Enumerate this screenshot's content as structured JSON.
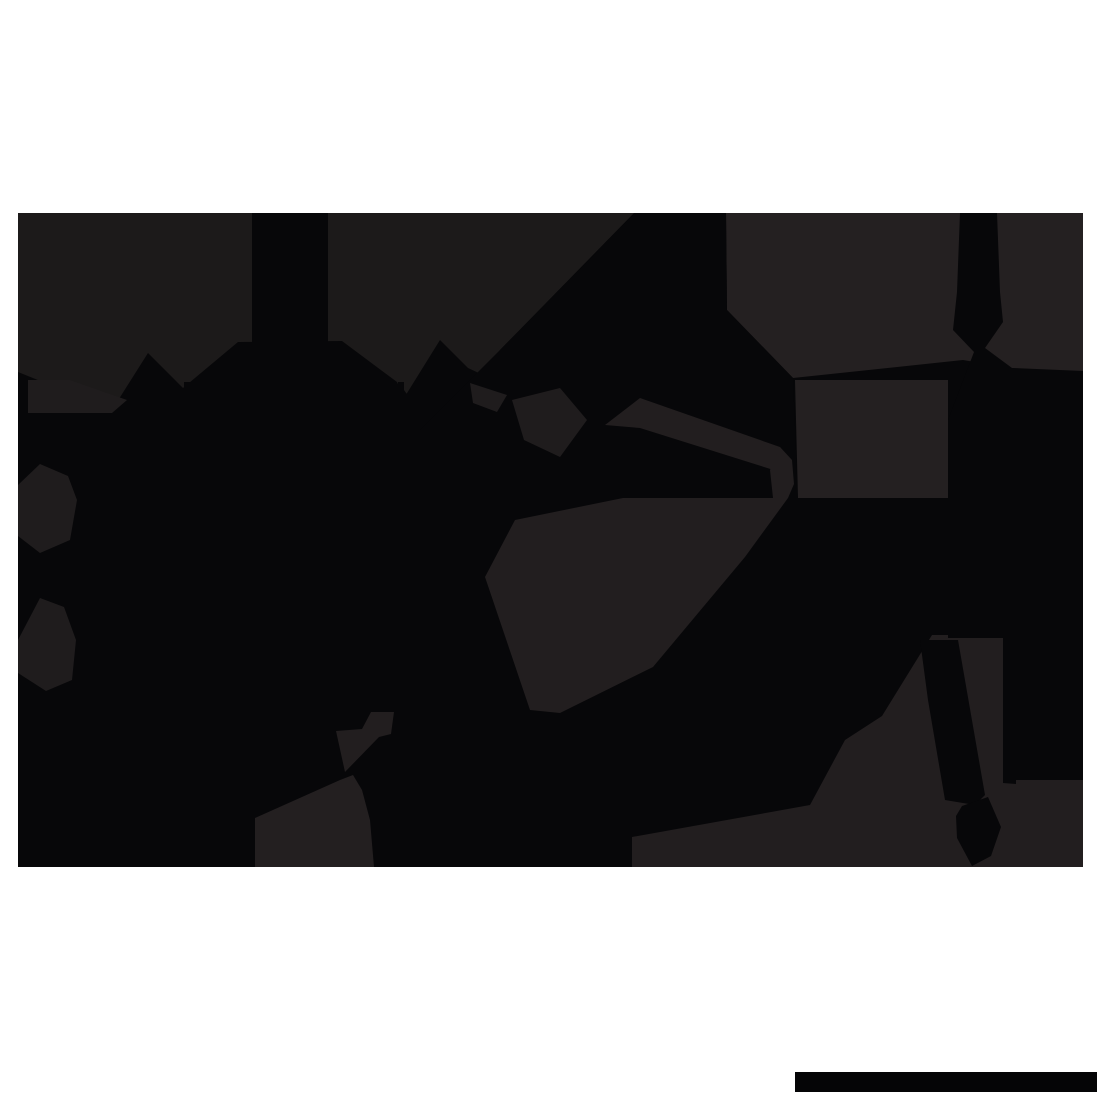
{
  "canvas": {
    "width": 1100,
    "height": 1100,
    "background": "#ffffff"
  },
  "artwork": {
    "kind": "silhouette-illustration",
    "bounds": {
      "left": 18,
      "top": 213,
      "right": 1083,
      "bottom": 867
    }
  },
  "colors": {
    "black": "#070709",
    "charcoal_left": "#1c1a1a",
    "charcoal_right": "#242021",
    "charcoal_mid": "#221e1f",
    "charcoal_building": "#231f20",
    "charcoal_detail": "#1f1c1d",
    "bar_black": "#050506",
    "background": "#ffffff"
  },
  "shapes": [
    {
      "name": "silhouette-base",
      "points": "18,213 1083,213 1083,867 18,867",
      "fill": "#070709"
    },
    {
      "name": "sky-band-left",
      "points": "18,213 634,213 500,350 483,375 468,368 440,340 404,398 397,382 342,341 238,342 183,388 148,353 112,410 18,372",
      "fill": "#1c1a1a"
    },
    {
      "name": "sky-band-right",
      "points": "726,213 1083,213 1083,372 1010,368 963,360 793,378 727,310",
      "fill": "#242021"
    },
    {
      "name": "diagonal-beam",
      "points": "635,213 726,213 727,310 793,378 798,498 420,498 420,430 500,350",
      "fill": "#070709"
    },
    {
      "name": "right-flank-panel",
      "points": "795,380 948,380 948,498 798,498",
      "fill": "#242021"
    },
    {
      "name": "highlight-wedge-small",
      "points": "470,383 507,395 497,412 473,403",
      "fill": "#1f1c1d"
    },
    {
      "name": "highlight-wedge-large",
      "points": "512,400 560,388 587,420 560,457 524,440",
      "fill": "#1f1c1d"
    },
    {
      "name": "highlight-band-upper",
      "points": "605,425 640,398 780,447 788,462 780,472 640,428",
      "fill": "#221e1f"
    },
    {
      "name": "highlight-band-knob",
      "points": "780,447 792,460 794,484 788,498 773,498 770,470",
      "fill": "#221e1f"
    },
    {
      "name": "highlight-wedge-lower",
      "points": "623,498 788,498 745,557 653,667 560,713 530,710 485,577 515,520",
      "fill": "#221e1f"
    },
    {
      "name": "bottom-right-terrain",
      "points": "632,867 632,837 810,805 845,740 882,716 932,635 1083,635 1083,867",
      "fill": "#221e1f"
    },
    {
      "name": "bottom-building",
      "points": "255,867 255,818 340,780 353,775 362,790 370,820 374,867",
      "fill": "#231f20"
    },
    {
      "name": "left-roof-trapezoid",
      "points": "28,380 70,380 127,400 112,413 28,413",
      "fill": "#1f1c1d"
    },
    {
      "name": "left-blob-upper",
      "points": "18,485 40,464 68,476 77,500 70,540 40,553 18,536",
      "fill": "#1f1c1d"
    },
    {
      "name": "left-blob-lower",
      "points": "18,640 40,598 64,607 76,640 72,680 46,691 18,673",
      "fill": "#1f1c1d"
    },
    {
      "name": "pennant-shape",
      "points": "371,712 394,712 391,734 379,737 345,772 336,731 362,729",
      "fill": "#221e1f"
    },
    {
      "name": "castle-tower",
      "points": "252,213 328,213 328,350 252,350",
      "fill": "#070709"
    },
    {
      "name": "spire-finial-left",
      "points": "184,382 190,382 190,390 197,400 187,411 178,400 184,390",
      "fill": "#070709"
    },
    {
      "name": "spire-finial-right",
      "points": "398,382 404,382 404,390 411,400 401,411 392,400 398,390",
      "fill": "#070709"
    },
    {
      "name": "right-column-mass",
      "points": "960,213 997,213 1000,292 1003,322 985,348 1012,368 1083,371 1083,638 948,638 948,420 974,352 953,330 957,292",
      "fill": "#070709"
    },
    {
      "name": "descending-column",
      "points": "920,640 958,640 985,795 975,805 945,800 928,700",
      "fill": "#070709"
    },
    {
      "name": "teardrop-foot",
      "points": "962,806 988,797 1001,827 991,856 972,866 957,838 956,816",
      "fill": "#070709"
    },
    {
      "name": "right-lower-block",
      "points": "1003,636 1083,636 1083,780 1016,780 1016,784 1003,783",
      "fill": "#070709"
    },
    {
      "name": "bottom-right-bar",
      "points": "795,1072 1097,1072 1097,1092 795,1092",
      "fill": "#050506"
    }
  ]
}
